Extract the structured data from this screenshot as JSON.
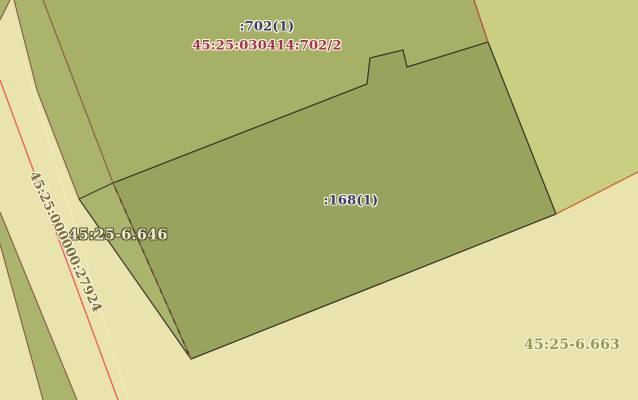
{
  "map": {
    "labels": {
      "parcel_702_unit": ":702(1)",
      "parcel_702_cadastral": "45:25:030414:702/2",
      "parcel_168_unit": ":168(1)",
      "zone_6646": "45:25-6.646",
      "zone_6663": "45:25-6.663",
      "road_cadastral": "45:25:000000:27924"
    },
    "colors": {
      "background_pale": "#e9e4ad",
      "parcel_green": "#a6b067",
      "strip_green": "#abb46c",
      "parcel_dark_olive": "#98a35d",
      "parcel_light_green": "#c9ce81",
      "boundary_brown": "#8a6148",
      "boundary_dark": "#3a3a2b",
      "road_centerline_red": "#f06060",
      "road_inner_line_cream": "#f1ecbe",
      "boundary_orange": "#c96e3e",
      "boundary_red_brown": "#b5503c",
      "label_navy": "#3b3b72",
      "label_crimson": "#a93253",
      "label_olive": "#9a9a4e",
      "label_olive_dark": "#7d6f3c",
      "label_halo_light": "#f7f3da",
      "label_halo_dark": "#56562f"
    }
  }
}
